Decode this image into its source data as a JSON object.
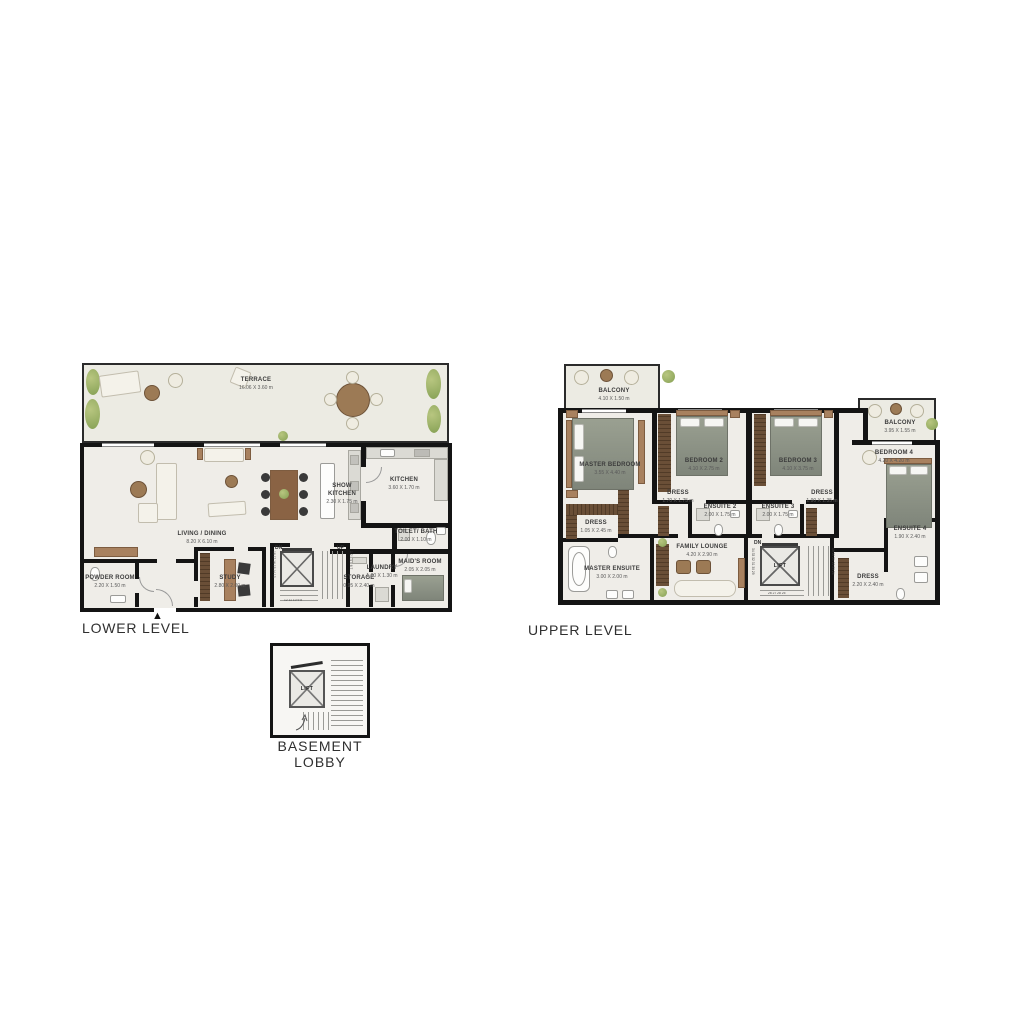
{
  "plans": {
    "lower": {
      "title": "LOWER LEVEL",
      "entry_marker": "▲",
      "rooms": {
        "terrace": {
          "name": "TERRACE",
          "dims": "16.06 X 3.60 m"
        },
        "living": {
          "name": "LIVING / DINING",
          "dims": "8.20 X 6.10 m"
        },
        "show_kitchen": {
          "name": "SHOW KITCHEN",
          "dims": "2.30 X 1.75 m"
        },
        "kitchen": {
          "name": "KITCHEN",
          "dims": "3.60 X 1.70 m"
        },
        "toilet_bath": {
          "name": "TOILET/ BATH",
          "dims": "2.00 X 1.10 m"
        },
        "powder": {
          "name": "POWDER ROOM",
          "dims": "2.20 X 1.50 m"
        },
        "study": {
          "name": "STUDY",
          "dims": "2.80 X 2.00 m"
        },
        "storage": {
          "name": "STORAGE",
          "dims": "0.95 X 2.40 m"
        },
        "laundry": {
          "name": "LAUNDRY",
          "dims": "1.00 X 1.30 m"
        },
        "maids": {
          "name": "MAID'S ROOM",
          "dims": "2.05 X 2.05 m"
        }
      },
      "stairs": {
        "dn": "DN",
        "up": "UP",
        "left_numbers": "18 17 16 15 14 13",
        "right_numbers": "1 2 3 4 5 6 7",
        "bottom_numbers": "12 11 10 9 8"
      }
    },
    "upper": {
      "title": "UPPER LEVEL",
      "lift_label": "LIFT",
      "rooms": {
        "balcony_left": {
          "name": "BALCONY",
          "dims": "4.10 X 1.50 m"
        },
        "master": {
          "name": "MASTER BEDROOM",
          "dims": "3.55 X 4.40 m"
        },
        "bedroom2": {
          "name": "BEDROOM 2",
          "dims": "4.10 X 2.75 m"
        },
        "bedroom3": {
          "name": "BEDROOM 3",
          "dims": "4.10 X 3.75 m"
        },
        "balcony_right": {
          "name": "BALCONY",
          "dims": "3.95 X 1.55 m"
        },
        "bedroom4": {
          "name": "BEDROOM 4",
          "dims": "4.20 X 4.20 m"
        },
        "dress_master": {
          "name": "DRESS",
          "dims": "1.05 X 2.45 m"
        },
        "dress2": {
          "name": "DRESS",
          "dims": "1.70 X 1.75 m"
        },
        "ensuite2": {
          "name": "ENSUITE 2",
          "dims": "2.00 X 1.75 m"
        },
        "ensuite3": {
          "name": "ENSUITE 3",
          "dims": "2.00 X 1.75 m"
        },
        "dress3": {
          "name": "DRESS",
          "dims": "1.90 X 1.35 m"
        },
        "master_ensuite": {
          "name": "MASTER ENSUITE",
          "dims": "3.00 X 2.00 m"
        },
        "family": {
          "name": "FAMILY LOUNGE",
          "dims": "4.20 X 2.90 m"
        },
        "ensuite4": {
          "name": "ENSUITE 4",
          "dims": "1.90 X 2.40 m"
        },
        "dress4": {
          "name": "DRESS",
          "dims": "2.20 X 2.40 m"
        }
      },
      "stairs": {
        "dn": "DN",
        "left_numbers": "34 33 32 31 30 29",
        "right_numbers": "19 20 21 22 23 24",
        "bottom_numbers": "26 27 28 25"
      }
    },
    "basement": {
      "title": "BASEMENT LOBBY",
      "lift_label": "LIFT"
    }
  },
  "colors": {
    "wall": "#141414",
    "floor": "#efede8",
    "terrace_floor": "#ecebe3",
    "wood": "#a8815f",
    "dark_wood": "#5f4733",
    "plant_green": "#8aa35c",
    "bed": "#8e9388",
    "fixture": "#fdfdfc"
  }
}
